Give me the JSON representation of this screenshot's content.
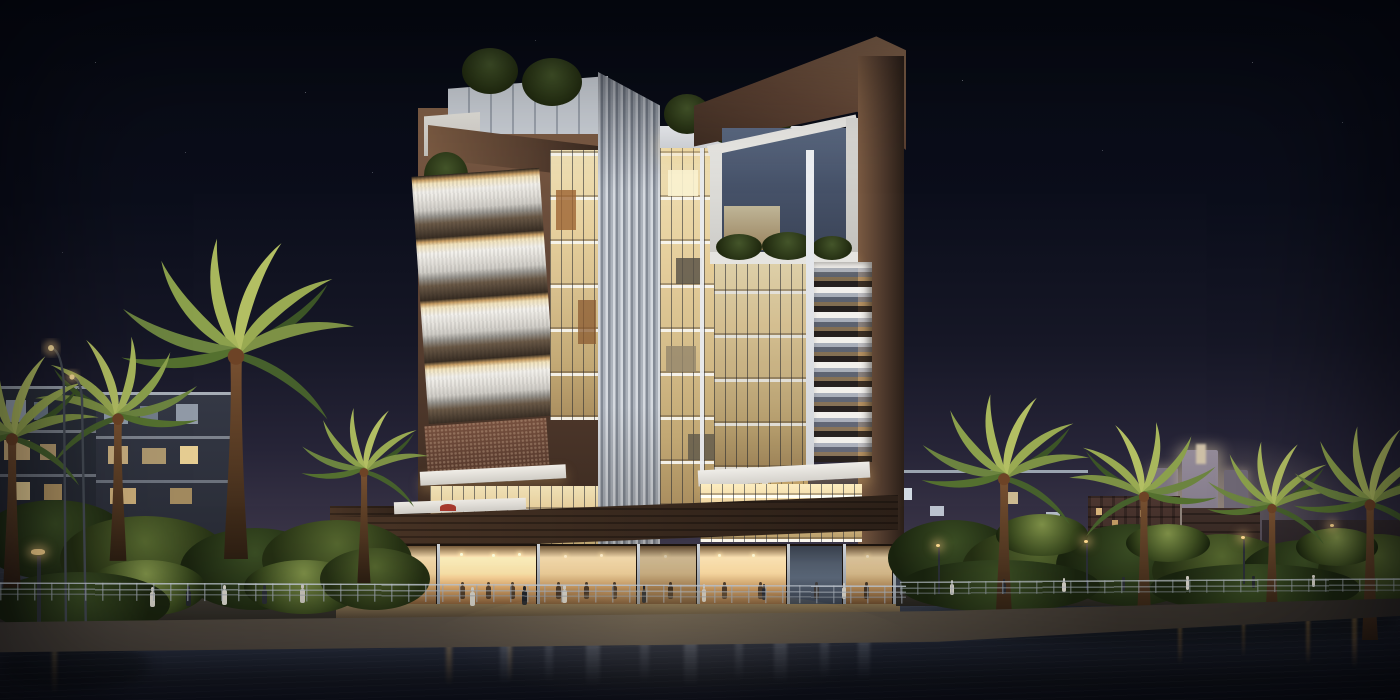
{
  "scene": {
    "type": "architectural-rendering",
    "time_of_day": "night",
    "description": "Night rendering of a modern mixed-use residential tower on a canal-front promenade: brown stone portal frames, warm-lit glass curtain walls, stacked white balconies, a vertical louvre fin, rooftop gardens, a glowing ground-floor restaurant, palm trees and street lamps along the water, city blocks and a glowing distant skyline behind, reflections in dark water."
  },
  "palette": {
    "sky_top": "#070a13",
    "sky_horizon": "#575166",
    "stone_frame": "#5d4233",
    "warm_glass": "#f0e1b6",
    "balcony_white": "#f3f1ec",
    "louvre_fin": "#acb2bb",
    "podium_brick": "#3a2a1f",
    "restaurant_glow": "#f6dcae",
    "cool_glass": "#56627a",
    "palm_lit": "#aab859",
    "palm_dark": "#3a5226",
    "lamp_glow": "#ffd98f",
    "water_light": "#4e5565",
    "water_dark": "#121520",
    "skyline_glow": "#d8c6a8",
    "accent_umbrella_red": "#a6392e"
  },
  "objects": {
    "sky": "night sky with faint stars",
    "main_tower": "12-storey residential tower with stone frames and lit glass",
    "left_balcony_stack": "cantilevered white balconies in stone frame",
    "louvre_fin": "full-height vertical white louvre element",
    "right_portal_frame": "brown stone portal with white inner frame",
    "podium_restaurant": "glazed ground-floor restaurant with diners",
    "promenade": "waterfront walkway with railing, lamps and pedestrians",
    "palms": "illuminated date palms",
    "background_buildings": "mid-rise apartment blocks and brick buildings",
    "distant_skyline": "glowing towers on the horizon",
    "water": "canal with light reflections"
  }
}
